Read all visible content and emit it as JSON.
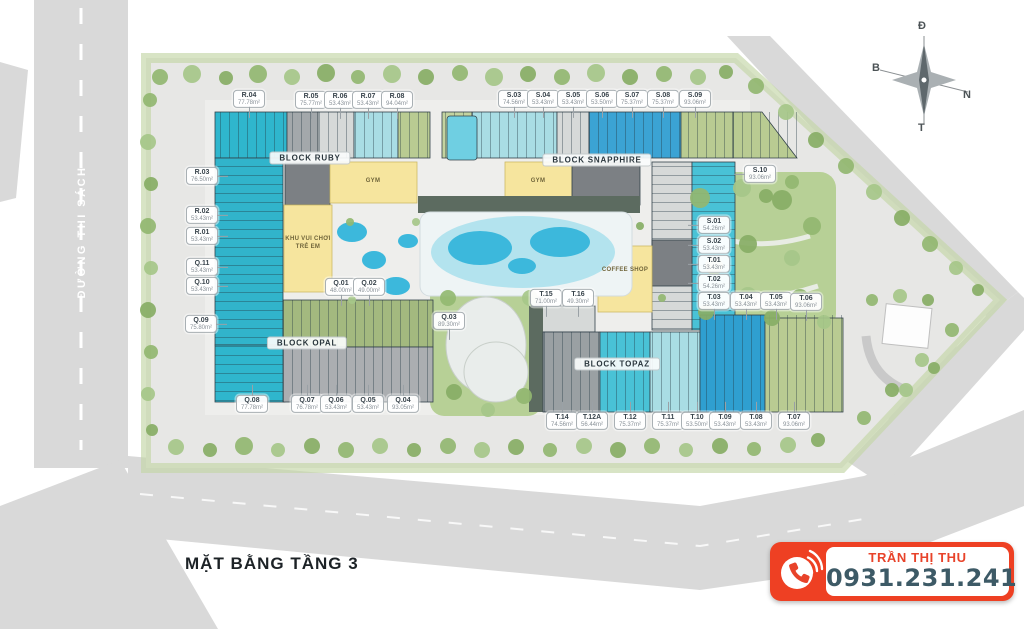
{
  "title": "MẶT BẰNG TẦNG 3",
  "street": "ĐƯỜNG THI SÁCH",
  "compass": {
    "top": "Đ",
    "left": "B",
    "right": "N",
    "bottom": "T"
  },
  "contact": {
    "name": "TRẦN THỊ THU",
    "phone": "0931.231.241",
    "accent_color": "#ee4023",
    "phone_text_color": "#3d5a66"
  },
  "colors": {
    "road": "#d9d9d9",
    "site": "#e7e7e5",
    "green": "#b7d096",
    "pool": "#3cb8dc",
    "teal_unit": "#2fb6cd",
    "cyan_unit": "#49c2d6",
    "light_cyan_unit": "#a9dde4",
    "blue_unit": "#3ba3d4",
    "green_unit": "#b9cb92",
    "amenity_yellow": "#f6e59e"
  },
  "blocks": [
    {
      "name": "BLOCK RUBY",
      "x": 310,
      "y": 158
    },
    {
      "name": "BLOCK SNAPPHIRE",
      "x": 597,
      "y": 160
    },
    {
      "name": "BLOCK OPAL",
      "x": 307,
      "y": 343
    },
    {
      "name": "BLOCK TOPAZ",
      "x": 617,
      "y": 364
    }
  ],
  "amenities": [
    {
      "label": "GYM",
      "x": 373,
      "y": 182
    },
    {
      "label": "GYM",
      "x": 538,
      "y": 182
    },
    {
      "label": "KHU VUI CHƠI\nTRẺ EM",
      "x": 308,
      "y": 244
    },
    {
      "label": "COFFEE SHOP",
      "x": 625,
      "y": 271
    }
  ],
  "units": [
    {
      "id": "R.04",
      "area": "77.78m²",
      "x": 249,
      "y": 99,
      "dir": "down"
    },
    {
      "id": "R.05",
      "area": "75.77m²",
      "x": 311,
      "y": 100,
      "dir": "down"
    },
    {
      "id": "R.06",
      "area": "53.43m²",
      "x": 340,
      "y": 100,
      "dir": "down"
    },
    {
      "id": "R.07",
      "area": "53.43m²",
      "x": 368,
      "y": 100,
      "dir": "down"
    },
    {
      "id": "R.08",
      "area": "94.04m²",
      "x": 397,
      "y": 100,
      "dir": "down"
    },
    {
      "id": "S.03",
      "area": "74.56m²",
      "x": 514,
      "y": 99,
      "dir": "down"
    },
    {
      "id": "S.04",
      "area": "53.43m²",
      "x": 543,
      "y": 99,
      "dir": "down"
    },
    {
      "id": "S.05",
      "area": "53.43m²",
      "x": 573,
      "y": 99,
      "dir": "down"
    },
    {
      "id": "S.06",
      "area": "53.50m²",
      "x": 602,
      "y": 99,
      "dir": "down"
    },
    {
      "id": "S.07",
      "area": "75.37m²",
      "x": 632,
      "y": 99,
      "dir": "down"
    },
    {
      "id": "S.08",
      "area": "75.37m²",
      "x": 663,
      "y": 99,
      "dir": "down"
    },
    {
      "id": "S.09",
      "area": "93.06m²",
      "x": 695,
      "y": 99,
      "dir": "down"
    },
    {
      "id": "R.03",
      "area": "76.50m²",
      "x": 202,
      "y": 176,
      "dir": "right"
    },
    {
      "id": "R.02",
      "area": "53.43m²",
      "x": 202,
      "y": 215,
      "dir": "right"
    },
    {
      "id": "R.01",
      "area": "53.43m²",
      "x": 202,
      "y": 236,
      "dir": "right"
    },
    {
      "id": "Q.11",
      "area": "53.43m²",
      "x": 202,
      "y": 267,
      "dir": "right"
    },
    {
      "id": "Q.10",
      "area": "53.43m²",
      "x": 202,
      "y": 286,
      "dir": "right"
    },
    {
      "id": "Q.09",
      "area": "75.80m²",
      "x": 201,
      "y": 324,
      "dir": "right"
    },
    {
      "id": "S.10",
      "area": "93.06m²",
      "x": 760,
      "y": 174,
      "dir": "left"
    },
    {
      "id": "S.01",
      "area": "54.26m²",
      "x": 714,
      "y": 225,
      "dir": "left"
    },
    {
      "id": "S.02",
      "area": "53.43m²",
      "x": 714,
      "y": 245,
      "dir": "left"
    },
    {
      "id": "T.01",
      "area": "53.43m²",
      "x": 714,
      "y": 264,
      "dir": "left"
    },
    {
      "id": "T.02",
      "area": "54.26m²",
      "x": 714,
      "y": 283,
      "dir": "left"
    },
    {
      "id": "T.03",
      "area": "53.43m²",
      "x": 714,
      "y": 301,
      "dir": "down"
    },
    {
      "id": "T.04",
      "area": "53.43m²",
      "x": 746,
      "y": 301,
      "dir": "down"
    },
    {
      "id": "T.05",
      "area": "53.43m²",
      "x": 776,
      "y": 301,
      "dir": "down"
    },
    {
      "id": "T.06",
      "area": "93.06m²",
      "x": 806,
      "y": 302,
      "dir": "down"
    },
    {
      "id": "Q.08",
      "area": "77.78m²",
      "x": 252,
      "y": 404,
      "dir": "up"
    },
    {
      "id": "Q.07",
      "area": "76.78m²",
      "x": 307,
      "y": 404,
      "dir": "up"
    },
    {
      "id": "Q.06",
      "area": "53.43m²",
      "x": 336,
      "y": 404,
      "dir": "up"
    },
    {
      "id": "Q.05",
      "area": "53.43m²",
      "x": 368,
      "y": 404,
      "dir": "up"
    },
    {
      "id": "Q.04",
      "area": "93.05m²",
      "x": 403,
      "y": 404,
      "dir": "up"
    },
    {
      "id": "T.14",
      "area": "74.56m²",
      "x": 562,
      "y": 421,
      "dir": "up"
    },
    {
      "id": "T.12A",
      "area": "56.44m²",
      "x": 592,
      "y": 421,
      "dir": "up"
    },
    {
      "id": "T.12",
      "area": "75.37m²",
      "x": 630,
      "y": 421,
      "dir": "up"
    },
    {
      "id": "T.11",
      "area": "75.37m²",
      "x": 668,
      "y": 421,
      "dir": "up"
    },
    {
      "id": "T.10",
      "area": "53.50m²",
      "x": 697,
      "y": 421,
      "dir": "up"
    },
    {
      "id": "T.09",
      "area": "53.43m²",
      "x": 725,
      "y": 421,
      "dir": "up"
    },
    {
      "id": "T.08",
      "area": "53.43m²",
      "x": 756,
      "y": 421,
      "dir": "up"
    },
    {
      "id": "T.07",
      "area": "93.06m²",
      "x": 794,
      "y": 421,
      "dir": "up"
    },
    {
      "id": "Q.01",
      "area": "48.00m²",
      "x": 341,
      "y": 287,
      "dir": "down"
    },
    {
      "id": "Q.02",
      "area": "49.00m²",
      "x": 369,
      "y": 287,
      "dir": "down"
    },
    {
      "id": "Q.03",
      "area": "89.30m²",
      "x": 449,
      "y": 321,
      "dir": "down"
    },
    {
      "id": "T.15",
      "area": "71.00m²",
      "x": 546,
      "y": 298,
      "dir": "down"
    },
    {
      "id": "T.16",
      "area": "49.30m²",
      "x": 578,
      "y": 298,
      "dir": "down"
    }
  ]
}
